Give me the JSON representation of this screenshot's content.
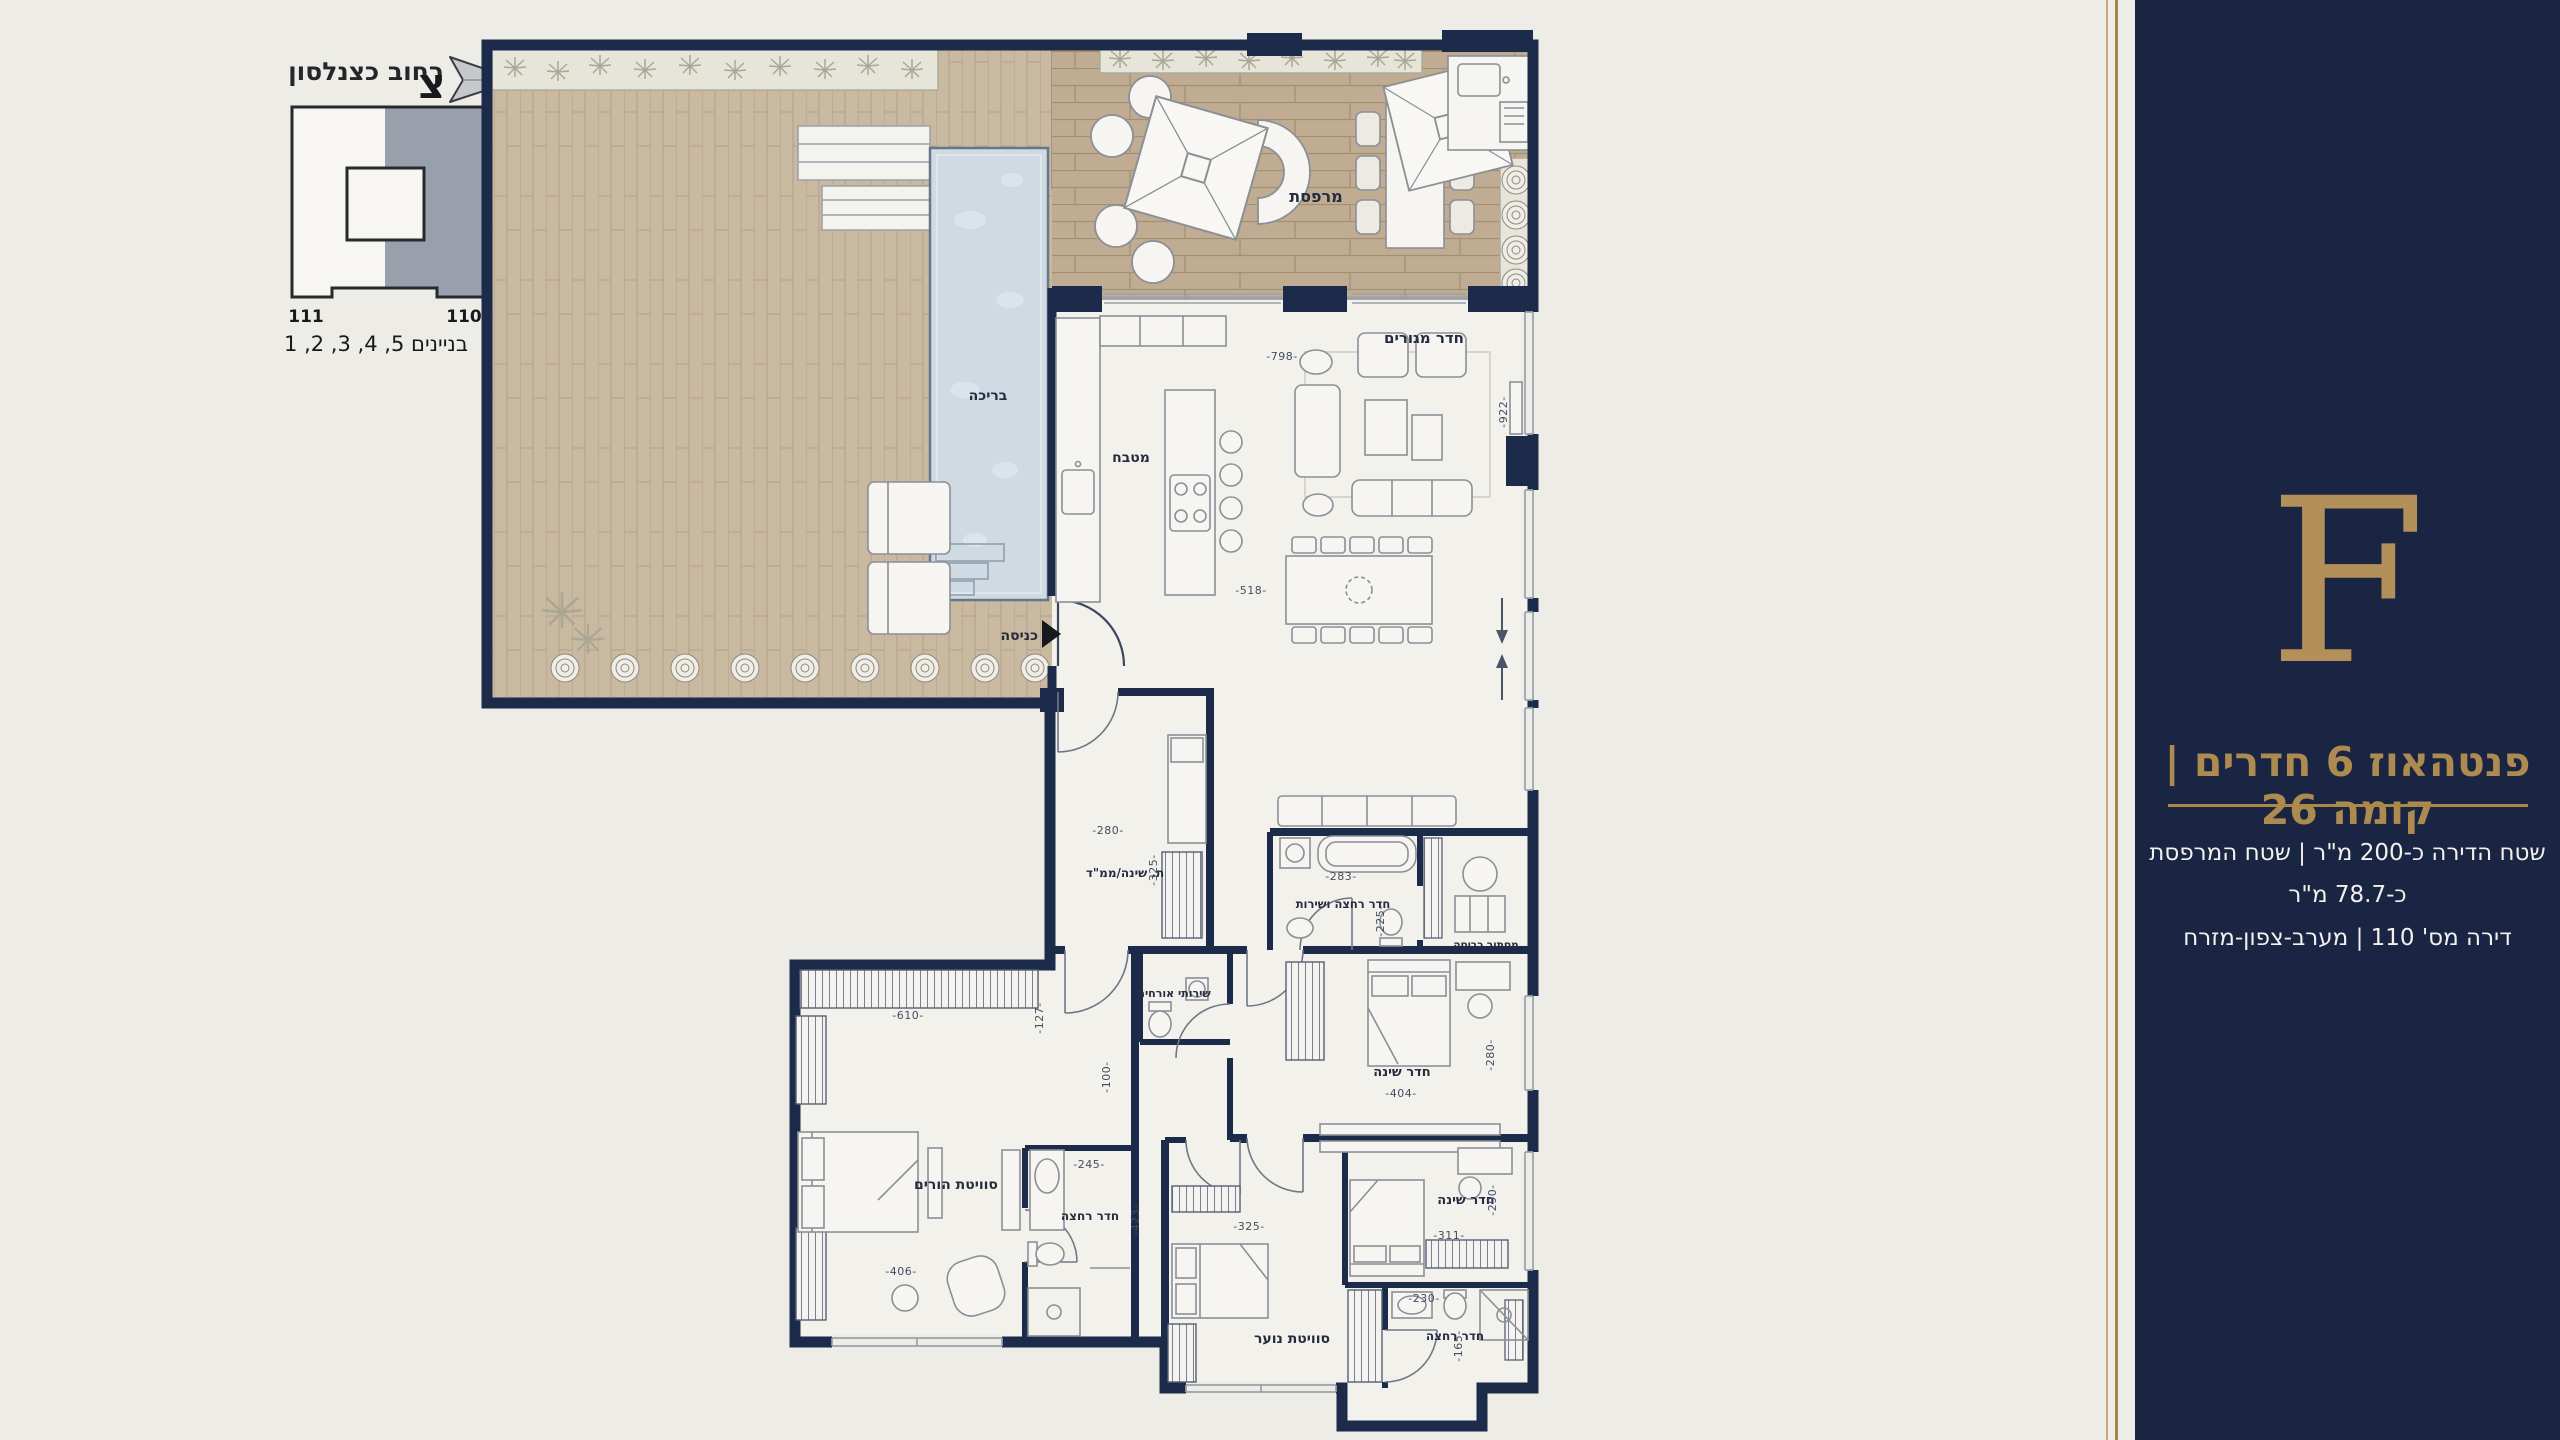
{
  "legend": {
    "street": "רחוב כצנלסון",
    "north": "צ",
    "b111": "111",
    "b110": "110",
    "buildings": "בניינים 5, 4, 3, 2, 1"
  },
  "sidebar": {
    "letter": "F",
    "title": "פנטהאוז 6 חדרים | קומה 26",
    "area_line": "שטח הדירה כ-200 מ\"ר | שטח המרפסת כ-78.7 מ\"ר",
    "unit_line": "דירה מס' 110 | מערב-צפון-מזרח"
  },
  "rooms": {
    "pool": "בריכה",
    "terrace": "מרפסת",
    "living": "חדר מגורים",
    "kitchen": "מטבח",
    "entrance": "כניסה",
    "mamad": "ת. שינה/ממ\"ד",
    "guest_wc": "שירותי אורחים",
    "bath_service": "חדר רחצה ושירות",
    "laundry": "מסתור כביסה",
    "parents": "סוויטת הורים",
    "parents_bath": "חדר רחצה",
    "bed1": "חדר שינה",
    "bed2": "חדר שינה",
    "youth": "סוויטת נוער",
    "youth_bath": "חדר רחצה"
  },
  "dims": {
    "d798": "-798-",
    "d922": "-922-",
    "d518": "-518-",
    "d280a": "-280-",
    "d325a": "-325-",
    "d100": "-100-",
    "d283": "-283-",
    "d225": "-225-",
    "d610": "-610-",
    "d127": "-127-",
    "d406": "-406-",
    "d245": "-245-",
    "d423": "-423-",
    "d404": "-404-",
    "d280b": "-280-",
    "d311": "-311-",
    "d290": "-290-",
    "d230": "-230-",
    "d165": "-165-",
    "d325b": "-325-"
  },
  "colors": {
    "navy": "#1c2b4a",
    "gold": "#ae8b51",
    "background": "#edece7",
    "terrace_wood": "#bfac92",
    "deck_wood": "#c9b9a1",
    "pool_water": "#cfdae3",
    "keyplan_gray": "#9aa0ab"
  }
}
